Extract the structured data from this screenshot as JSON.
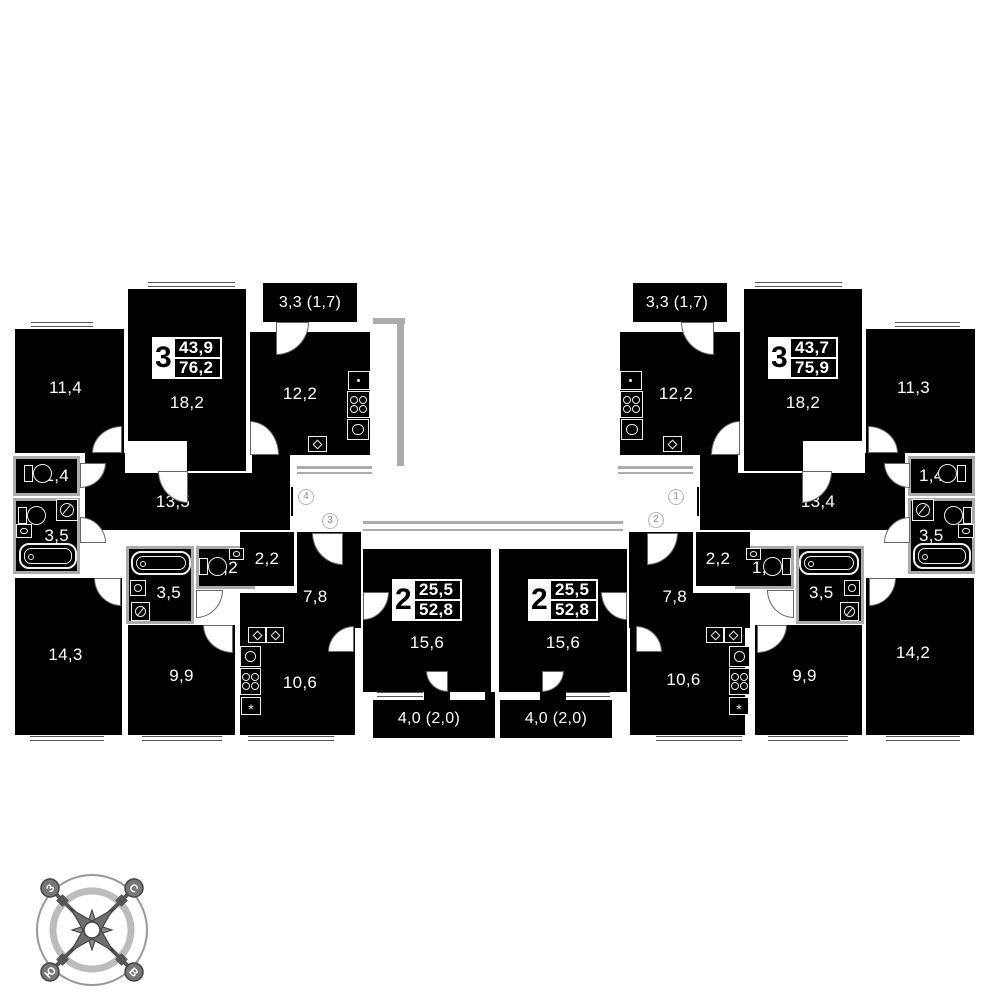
{
  "plan_type": "apartment-floor-plan",
  "apartments": [
    {
      "id": "left-3-room",
      "rooms": "3",
      "area_living": "43,9",
      "area_total": "76,2"
    },
    {
      "id": "right-3-room",
      "rooms": "3",
      "area_living": "43,7",
      "area_total": "75,9"
    },
    {
      "id": "left-2-room",
      "rooms": "2",
      "area_living": "25,5",
      "area_total": "52,8"
    },
    {
      "id": "right-2-room",
      "rooms": "2",
      "area_living": "25,5",
      "area_total": "52,8"
    }
  ],
  "rooms": {
    "l_11_4": "11,4",
    "l_18_2": "18,2",
    "l_balc_33": "3,3 (1,7)",
    "l_12_2": "12,2",
    "l_13_5": "13,5",
    "l_1_4": "1,4",
    "l_3_5_a": "3,5",
    "l_14_3": "14,3",
    "l_3_5_b": "3,5",
    "l_1_2": "1,2",
    "l_2_2": "2,2",
    "l_7_8": "7,8",
    "l_9_9": "9,9",
    "l_10_6": "10,6",
    "l_15_6": "15,6",
    "l_balc_40": "4,0 (2,0)",
    "r_11_3": "11,3",
    "r_18_2": "18,2",
    "r_balc_33": "3,3 (1,7)",
    "r_12_2": "12,2",
    "r_13_4": "13,4",
    "r_1_4": "1,4",
    "r_3_5_a": "3,5",
    "r_14_2": "14,2",
    "r_3_5_b": "3,5",
    "r_1_2": "1,2",
    "r_2_2": "2,2",
    "r_7_8": "7,8",
    "r_9_9": "9,9",
    "r_10_6": "10,6",
    "r_15_6": "15,6",
    "r_balc_40": "4,0 (2,0)"
  },
  "unit_numbers": {
    "left_upper": "4",
    "left_lower": "3",
    "right_upper": "1",
    "right_lower": "2"
  },
  "compass": {
    "north": "С",
    "south": "Ю",
    "west": "З",
    "east": "В"
  },
  "colors": {
    "wall": "#000000",
    "accent_gray": "#ababab",
    "text": "#ffffff"
  }
}
